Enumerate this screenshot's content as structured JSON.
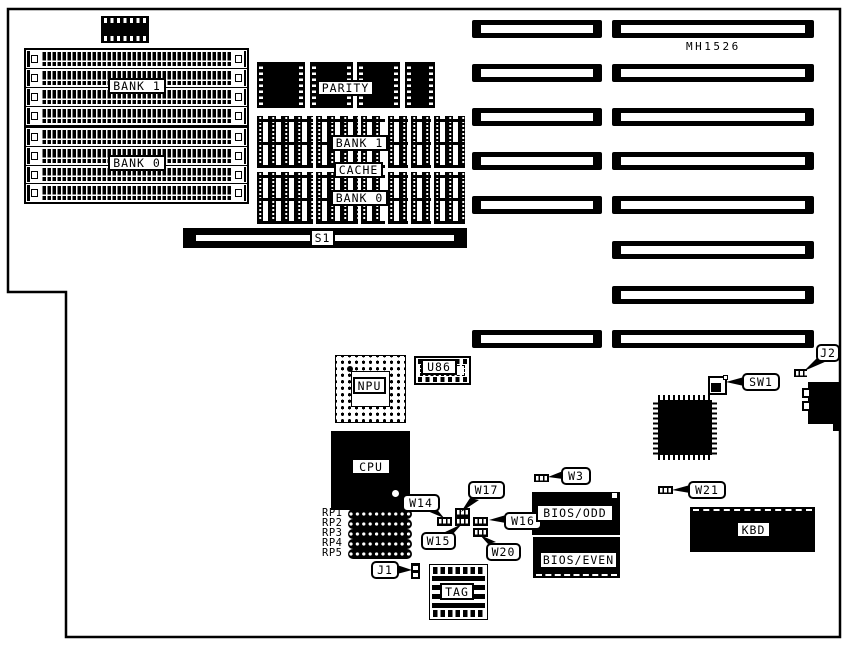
{
  "title": "MH1526",
  "colors": {
    "line": "#000000",
    "background": "#ffffff",
    "chip_fill": "#000000"
  },
  "memory": {
    "bank1": "BANK 1",
    "bank0": "BANK 0"
  },
  "cache": {
    "parity": "PARITY",
    "bank1": "BANK 1",
    "cache": "CACHE",
    "bank0": "BANK 0",
    "tag": "TAG"
  },
  "switches": {
    "s1": "S1",
    "sw1": "SW1"
  },
  "chips": {
    "npu": "NPU",
    "cpu": "CPU",
    "u86": "U86",
    "bios_odd": "BIOS/ODD",
    "bios_even": "BIOS/EVEN",
    "kbd": "KBD"
  },
  "jumpers": {
    "w3": "W3",
    "w14": "W14",
    "w15": "W15",
    "w16": "W16",
    "w17": "W17",
    "w20": "W20",
    "w21": "W21",
    "j1": "J1",
    "j2": "J2"
  },
  "resistor_packs": [
    "RP1",
    "RP2",
    "RP3",
    "RP4",
    "RP5"
  ]
}
